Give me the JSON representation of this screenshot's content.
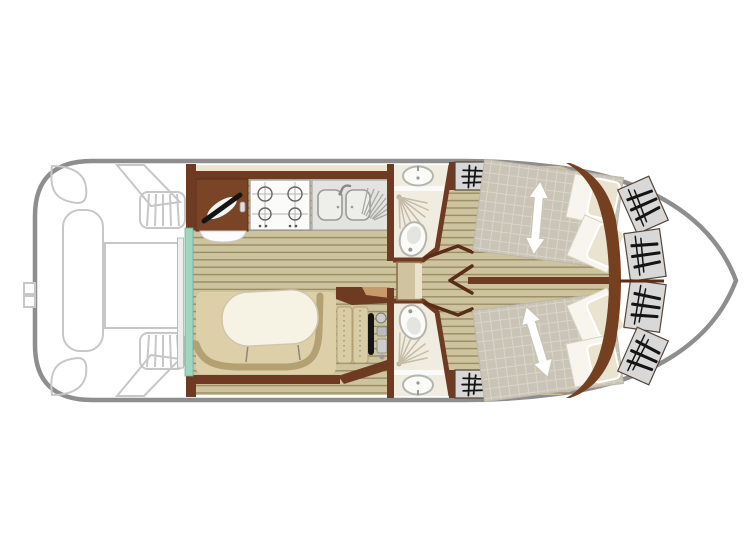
{
  "page": {
    "type": "boat-floor-plan",
    "background": "#ffffff",
    "orientation": "stern-left-bow-right"
  },
  "colors": {
    "hull": "#8e8e8e",
    "deck": "#c7c7c7",
    "wall": "#6e3a21",
    "walldark": "#5a2d17",
    "counter": "#7a4527",
    "floor_base": "#cdc39e",
    "floor_stripe": "#9a8c63",
    "bed_base": "#cac4b6",
    "bed_grid": "#dad5c9",
    "sofa": "#ddd0a8",
    "sofa_line": "#b3a173",
    "table": "#f6f2e4",
    "bath_floor": "#f0ece0",
    "fixture": "#b5b5b0",
    "teal_door": "#9fd6c0",
    "locker": "#d8d8d8",
    "pillow": "#e9e3cf",
    "cream_trim": "#ece5cf",
    "white": "#ffffff",
    "black": "#141414"
  },
  "plan": {
    "legend": [
      "hull-outline",
      "aft-deck",
      "stern-swim-ladder",
      "aft-bench",
      "aft-table",
      "deck-steps",
      "sliding-patio-door",
      "galley-counter",
      "gas-stove-4-burner",
      "double-sink-with-drainer",
      "salon-u-sofa",
      "salon-table",
      "helm-seat",
      "steering-wheel",
      "helm-controls",
      "bathroom-fore",
      "bathroom-aft",
      "washbasin",
      "shower",
      "toilet",
      "cabin-fore",
      "cabin-aft",
      "double-bed",
      "bed-convert-arrow",
      "pillows",
      "wardrobe",
      "bow-hanging-lockers",
      "corridor-doors"
    ]
  }
}
